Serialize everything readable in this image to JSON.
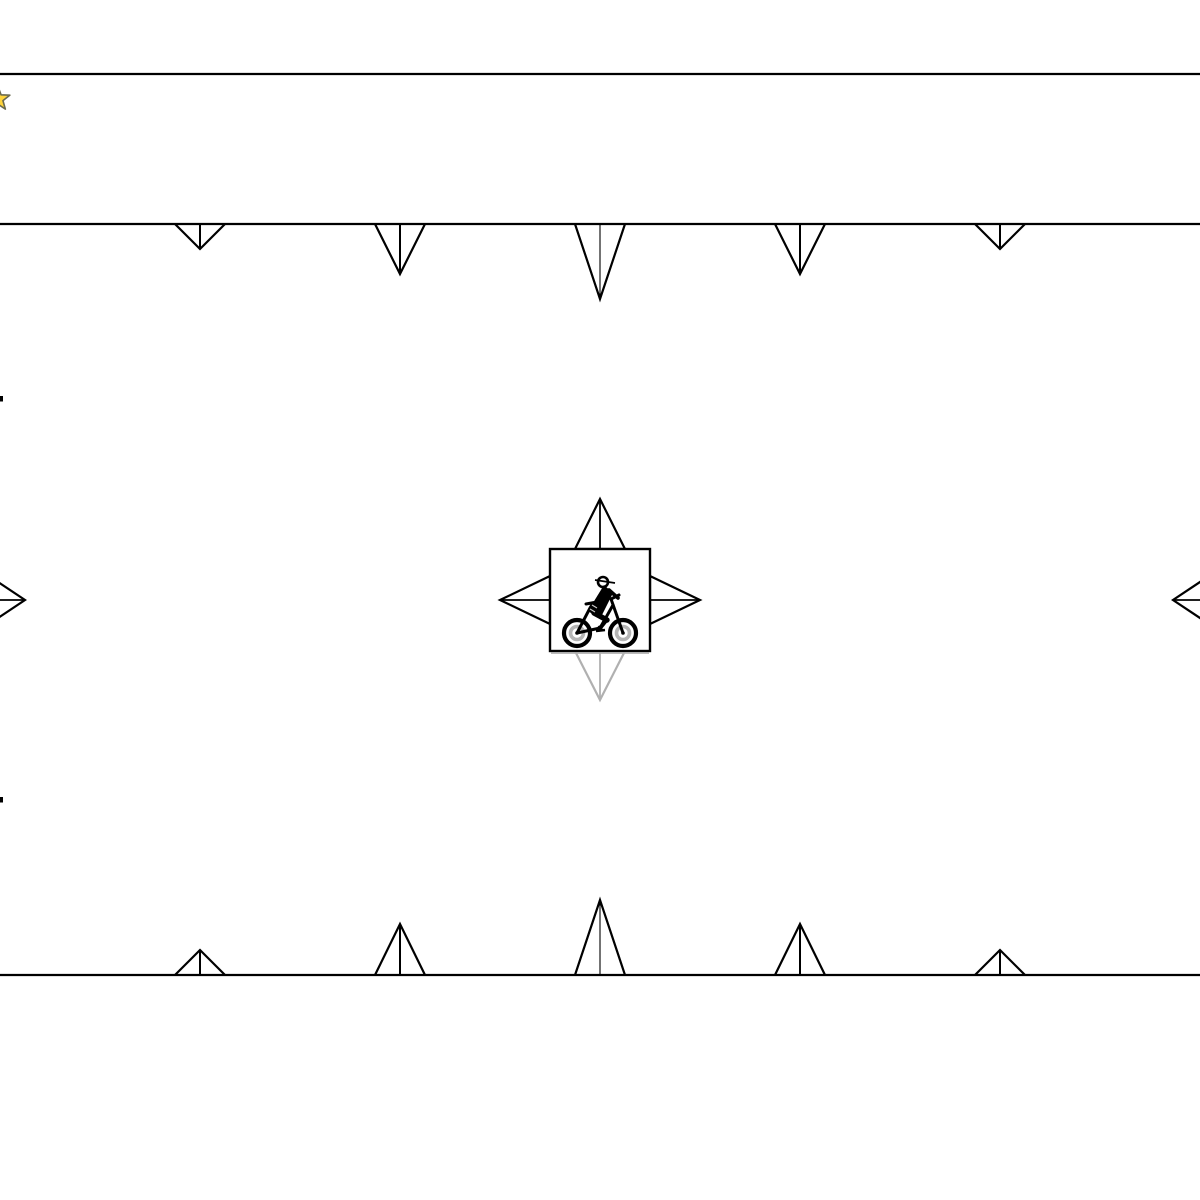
{
  "scene": {
    "canvas": {
      "width": 1200,
      "height": 1200,
      "background": "#ffffff"
    },
    "colors": {
      "line": "#000000",
      "active_arrow": "#000000",
      "inactive_arrow": "#b0b0b0"
    },
    "walls": [
      {
        "name": "top-wall",
        "y": 74
      },
      {
        "name": "upper-wall",
        "y": 224
      },
      {
        "name": "floor-wall",
        "y": 975
      }
    ],
    "ceiling_spikes": {
      "attach_y": 224,
      "half_width": 25,
      "spikes": [
        {
          "cx": 200,
          "size": 25
        },
        {
          "cx": 400,
          "size": 50
        },
        {
          "cx": 600,
          "size": 75
        },
        {
          "cx": 800,
          "size": 50
        },
        {
          "cx": 1000,
          "size": 25
        }
      ]
    },
    "floor_spikes": {
      "attach_y": 975,
      "half_width": 25,
      "spikes": [
        {
          "cx": 200,
          "size": 25
        },
        {
          "cx": 400,
          "size": 51
        },
        {
          "cx": 600,
          "size": 75
        },
        {
          "cx": 800,
          "size": 51
        },
        {
          "cx": 1000,
          "size": 25
        }
      ]
    },
    "star": {
      "cx": -2,
      "cy": 99,
      "outer_radius": 12.5,
      "inner_radius": 5.2,
      "fill": "#FFD43B",
      "outline": "#6A6A4F"
    },
    "player": {
      "icon": "mountain-biker",
      "box": {
        "x": 550,
        "y": 549,
        "width": 100,
        "height": 102
      },
      "move_arrows": [
        {
          "dir": "up",
          "length": 50,
          "half_width": 25,
          "color": "#000000",
          "enabled": true
        },
        {
          "dir": "left",
          "length": 50,
          "half_width": 24,
          "color": "#000000",
          "enabled": true
        },
        {
          "dir": "right",
          "length": 50,
          "half_width": 24,
          "color": "#000000",
          "enabled": true
        },
        {
          "dir": "down",
          "length": 49,
          "half_width": 25,
          "color": "#b0b0b0",
          "enabled": false
        }
      ]
    },
    "edge_arrows": [
      {
        "side": "left",
        "tip_x": 25,
        "tip_y": 600,
        "length": 75,
        "half_height": 50
      },
      {
        "side": "right",
        "tip_x": 1173,
        "tip_y": 600,
        "length": 75,
        "half_height": 50
      }
    ],
    "edge_marks": [
      {
        "x": 0,
        "y": 396
      },
      {
        "x": 0,
        "y": 797
      }
    ]
  }
}
